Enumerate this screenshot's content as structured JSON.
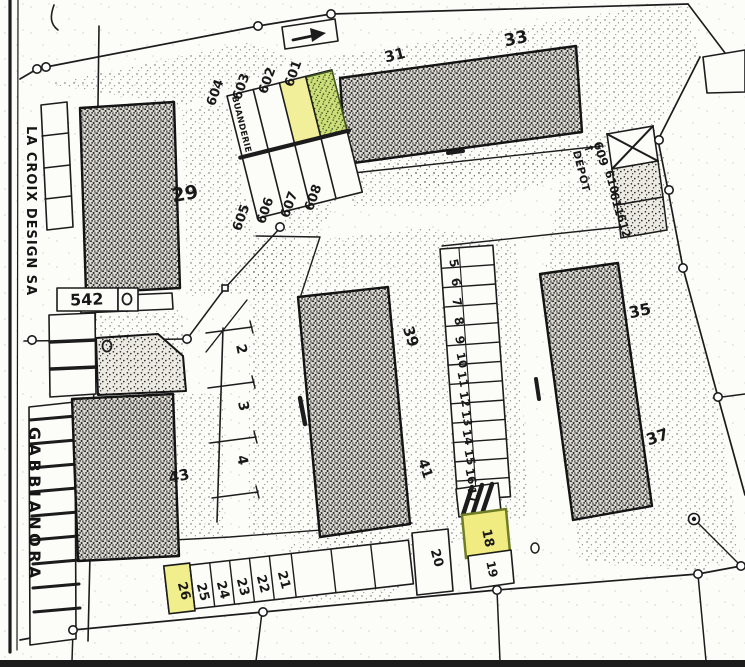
{
  "streets": {
    "la_croix": "LA CROIX DESIGN SA",
    "gabbianora": "GABBIANORA"
  },
  "plot_box": {
    "number": "542"
  },
  "buildings": {
    "b29": "29",
    "b31": "31",
    "b33": "33",
    "b35": "35",
    "b37": "37",
    "b39": "39",
    "b41": "41",
    "b43": "43"
  },
  "block600": {
    "c601": "601",
    "c602": "602",
    "c603": "603",
    "c604": "604",
    "c605": "605",
    "c606": "606",
    "c607": "607",
    "c608": "608",
    "buanderie": "BUANDERIE"
  },
  "depot": {
    "arrow": "↑",
    "label": "DÉPÔT",
    "c609": "609",
    "c610": "610",
    "c611": "611",
    "c612": "612"
  },
  "spots": {
    "s2": "2",
    "s3": "3",
    "s4": "4",
    "s5": "5",
    "s6": "6",
    "s7": "7",
    "s8": "8",
    "s9": "9",
    "s10": "10",
    "s11": "11",
    "s12": "12",
    "s13": "13",
    "s14": "14",
    "s15": "15",
    "s16": "16",
    "s17": "17",
    "s18": "18",
    "s19": "19",
    "s20": "20",
    "s21": "21",
    "s22": "22",
    "s23": "23",
    "s24": "24",
    "s25": "25",
    "s26": "26"
  },
  "highlights": {
    "yellow_spots": [
      "602",
      "18",
      "26"
    ],
    "green_spots": [
      "601"
    ],
    "yellow": "#f1ee8d",
    "green": "#ccdf78"
  },
  "colors": {
    "ink": "#1c1c1c",
    "paper": "#fcfcf9"
  }
}
